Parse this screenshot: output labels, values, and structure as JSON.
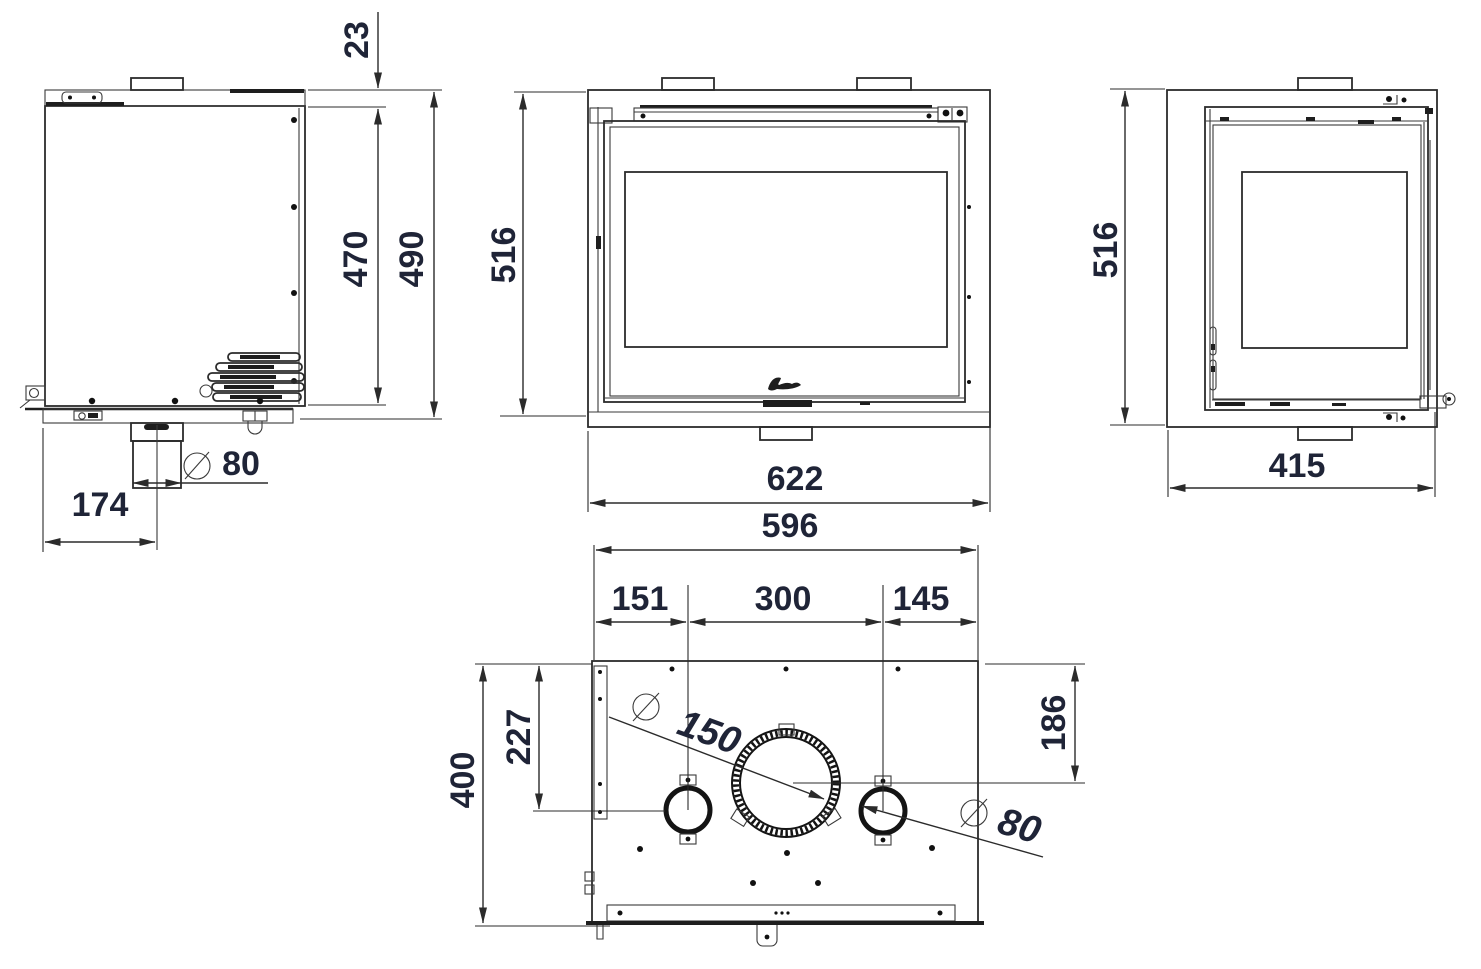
{
  "drawing": {
    "type": "technical-dimension-drawing",
    "subject": "fireplace-insert-stove",
    "views": {
      "side": "side-view",
      "front": "front-view",
      "right": "right-side-view",
      "top": "top-view"
    },
    "colors": {
      "line": "#2b2b2b",
      "text": "#1f2437",
      "background": "#ffffff"
    }
  },
  "dims": {
    "side": {
      "flange_offset": "23",
      "body_height": "470",
      "overall_height": "490",
      "duct_offset": "174",
      "duct_diameter": "80"
    },
    "front": {
      "height": "516",
      "width": "622"
    },
    "right": {
      "height": "516",
      "depth": "415"
    },
    "top": {
      "width": "596",
      "left_hole_offset": "151",
      "hole_spacing": "300",
      "right_hole_offset": "145",
      "depth": "400",
      "hole_center_depth": "227",
      "flue_center_depth": "186",
      "flue_diameter": "150",
      "outlet_diameter": "80"
    }
  }
}
